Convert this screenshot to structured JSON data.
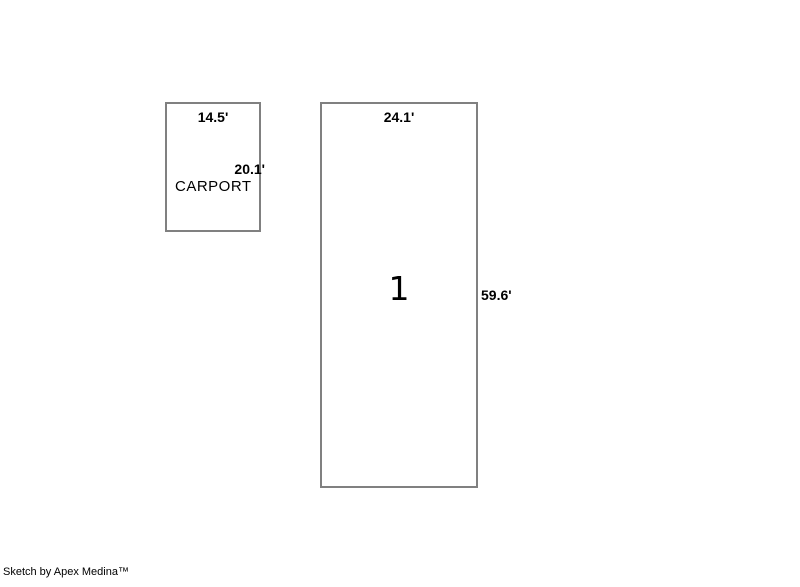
{
  "sketch": {
    "carport": {
      "name": "CARPORT",
      "top_dimension": "14.5'",
      "side_dimension": "20.1'"
    },
    "unit1": {
      "number": "1",
      "top_dimension": "24.1'",
      "side_dimension": "59.6'"
    },
    "footer": "Sketch by Apex Medina™",
    "colors": {
      "outline": "#808080",
      "text": "#000000",
      "background": "#ffffff"
    }
  }
}
